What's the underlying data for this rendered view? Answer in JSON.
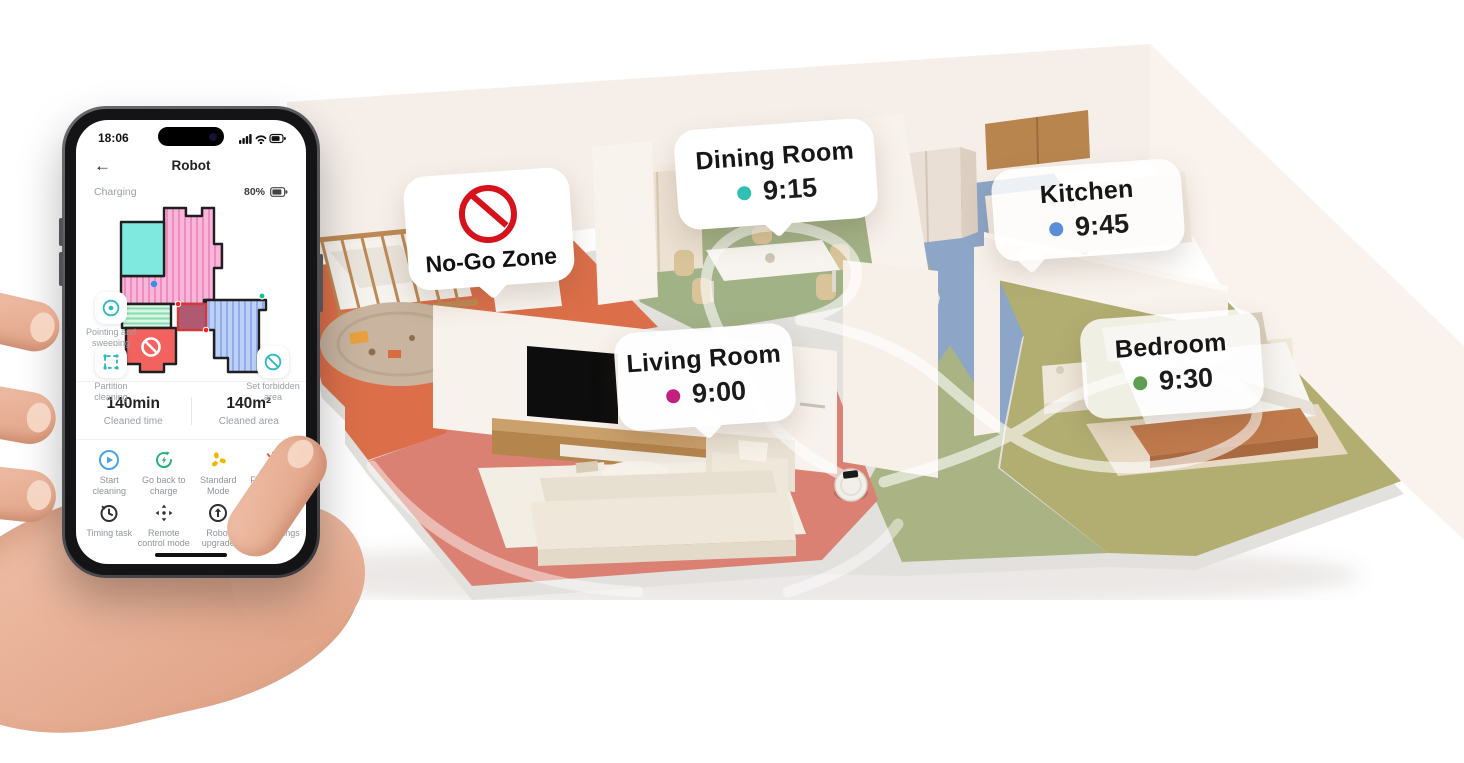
{
  "phone": {
    "status": {
      "time": "18:06"
    },
    "nav": {
      "title": "Robot",
      "back_glyph": "←"
    },
    "charging": {
      "label": "Charging",
      "battery": "80%"
    },
    "map_tools": [
      {
        "label": "Pointing and sweeping",
        "icon": "target-icon"
      },
      {
        "label": "Partition cleaning",
        "icon": "partition-icon"
      },
      {
        "label": "Set forbidden area",
        "icon": "no-entry-icon"
      }
    ],
    "stats": [
      {
        "value": "140min",
        "label": "Cleaned time"
      },
      {
        "value": "140m²",
        "label": "Cleaned area"
      }
    ],
    "actions": [
      {
        "label": "Start cleaning",
        "icon": "play-icon"
      },
      {
        "label": "Go back to charge",
        "icon": "recharge-icon"
      },
      {
        "label": "Standard Mode",
        "icon": "fan-icon"
      },
      {
        "label": "Find robots",
        "icon": "robot-face-icon"
      },
      {
        "label": "Timing task",
        "icon": "clock-icon"
      },
      {
        "label": "Remote control mode",
        "icon": "dpad-icon"
      },
      {
        "label": "Robot upgrade",
        "icon": "upgrade-icon"
      },
      {
        "label": "More settings",
        "icon": "gear-icon"
      }
    ]
  },
  "scene": {
    "no_go_zone": {
      "label": "No-Go Zone"
    },
    "rooms": [
      {
        "name": "Dining Room",
        "time": "9:15",
        "dot_color": "#2fbfb3"
      },
      {
        "name": "Kitchen",
        "time": "9:45",
        "dot_color": "#5b8ed8"
      },
      {
        "name": "Living Room",
        "time": "9:00",
        "dot_color": "#c21f7e"
      },
      {
        "name": "Bedroom",
        "time": "9:30",
        "dot_color": "#5d9e52"
      }
    ]
  },
  "colors": {
    "accent_teal": "#2fb9c3",
    "start_blue": "#4aa3e8",
    "charge_green": "#27b57a",
    "mode_yellow": "#f0b705",
    "find_red": "#e8543f",
    "nogo_red": "#d6121c"
  }
}
